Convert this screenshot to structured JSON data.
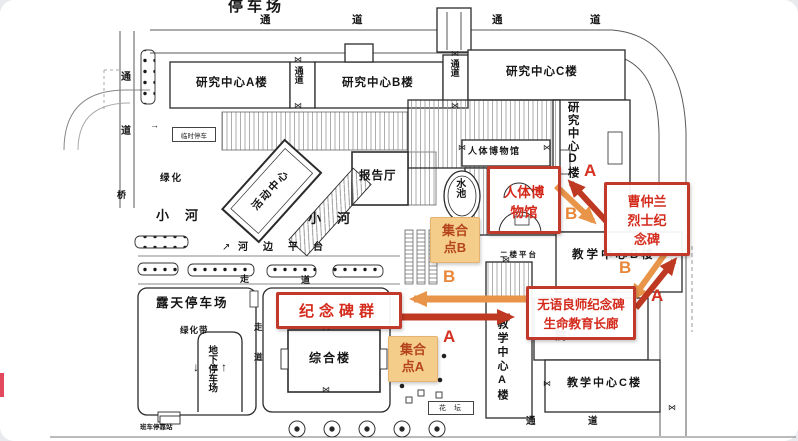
{
  "colors": {
    "annotation_red": "#c0392b",
    "annotation_text_red": "#d42a1c",
    "route_orange": "#e8954a",
    "route_red": "#bf3822",
    "assembly_bg": "#f5cd8a",
    "assembly_text": "#b5451c",
    "map_line": "#555555"
  },
  "chars": {
    "tong": "通",
    "dao": "道",
    "zou": "走",
    "qiao": "桥",
    "yuan": "院",
    "door": "⋈",
    "down_arrow": "↓",
    "up_arrow": "↑",
    "ne_arrow": "↗",
    "right_arrow": "→"
  },
  "buildings": {
    "research_a": "研究中心A楼",
    "research_b": "研究中心B楼",
    "research_c": "研究中心C楼",
    "research_d": "研究中心D楼",
    "corridor": "通道",
    "museum_plate": "人体博物馆",
    "lecture_hall": "报告厅",
    "activity_center": "活动中心",
    "comprehensive": "综合楼",
    "teach_a": "教学中心A楼",
    "teach_b": "教学中心B楼",
    "teach_c": "教学中心C楼"
  },
  "areas": {
    "parking_top": "停车场",
    "pool": "水池",
    "river": "小河",
    "riverside_platform": "河边平台",
    "green": "绿化",
    "green_belt": "绿化带",
    "open_parking": "露天停车场",
    "underground_parking": "地下停车场",
    "temp_parking": "临时停车",
    "shuttle_stop": "班车停靠站",
    "second_floor_platform": "二楼平台",
    "flower_bed": "花坛"
  },
  "annotations": {
    "museum": "人体博\n物馆",
    "cao_memorial": "曹仲兰\n烈士纪\n念碑",
    "monument_group": "纪念碑群",
    "wuyu": "无语良师纪念碑\n生命教育长廊",
    "meet_a": "集合\n点A",
    "meet_b": "集合\n点B",
    "marker_a": "A",
    "marker_b": "B"
  }
}
